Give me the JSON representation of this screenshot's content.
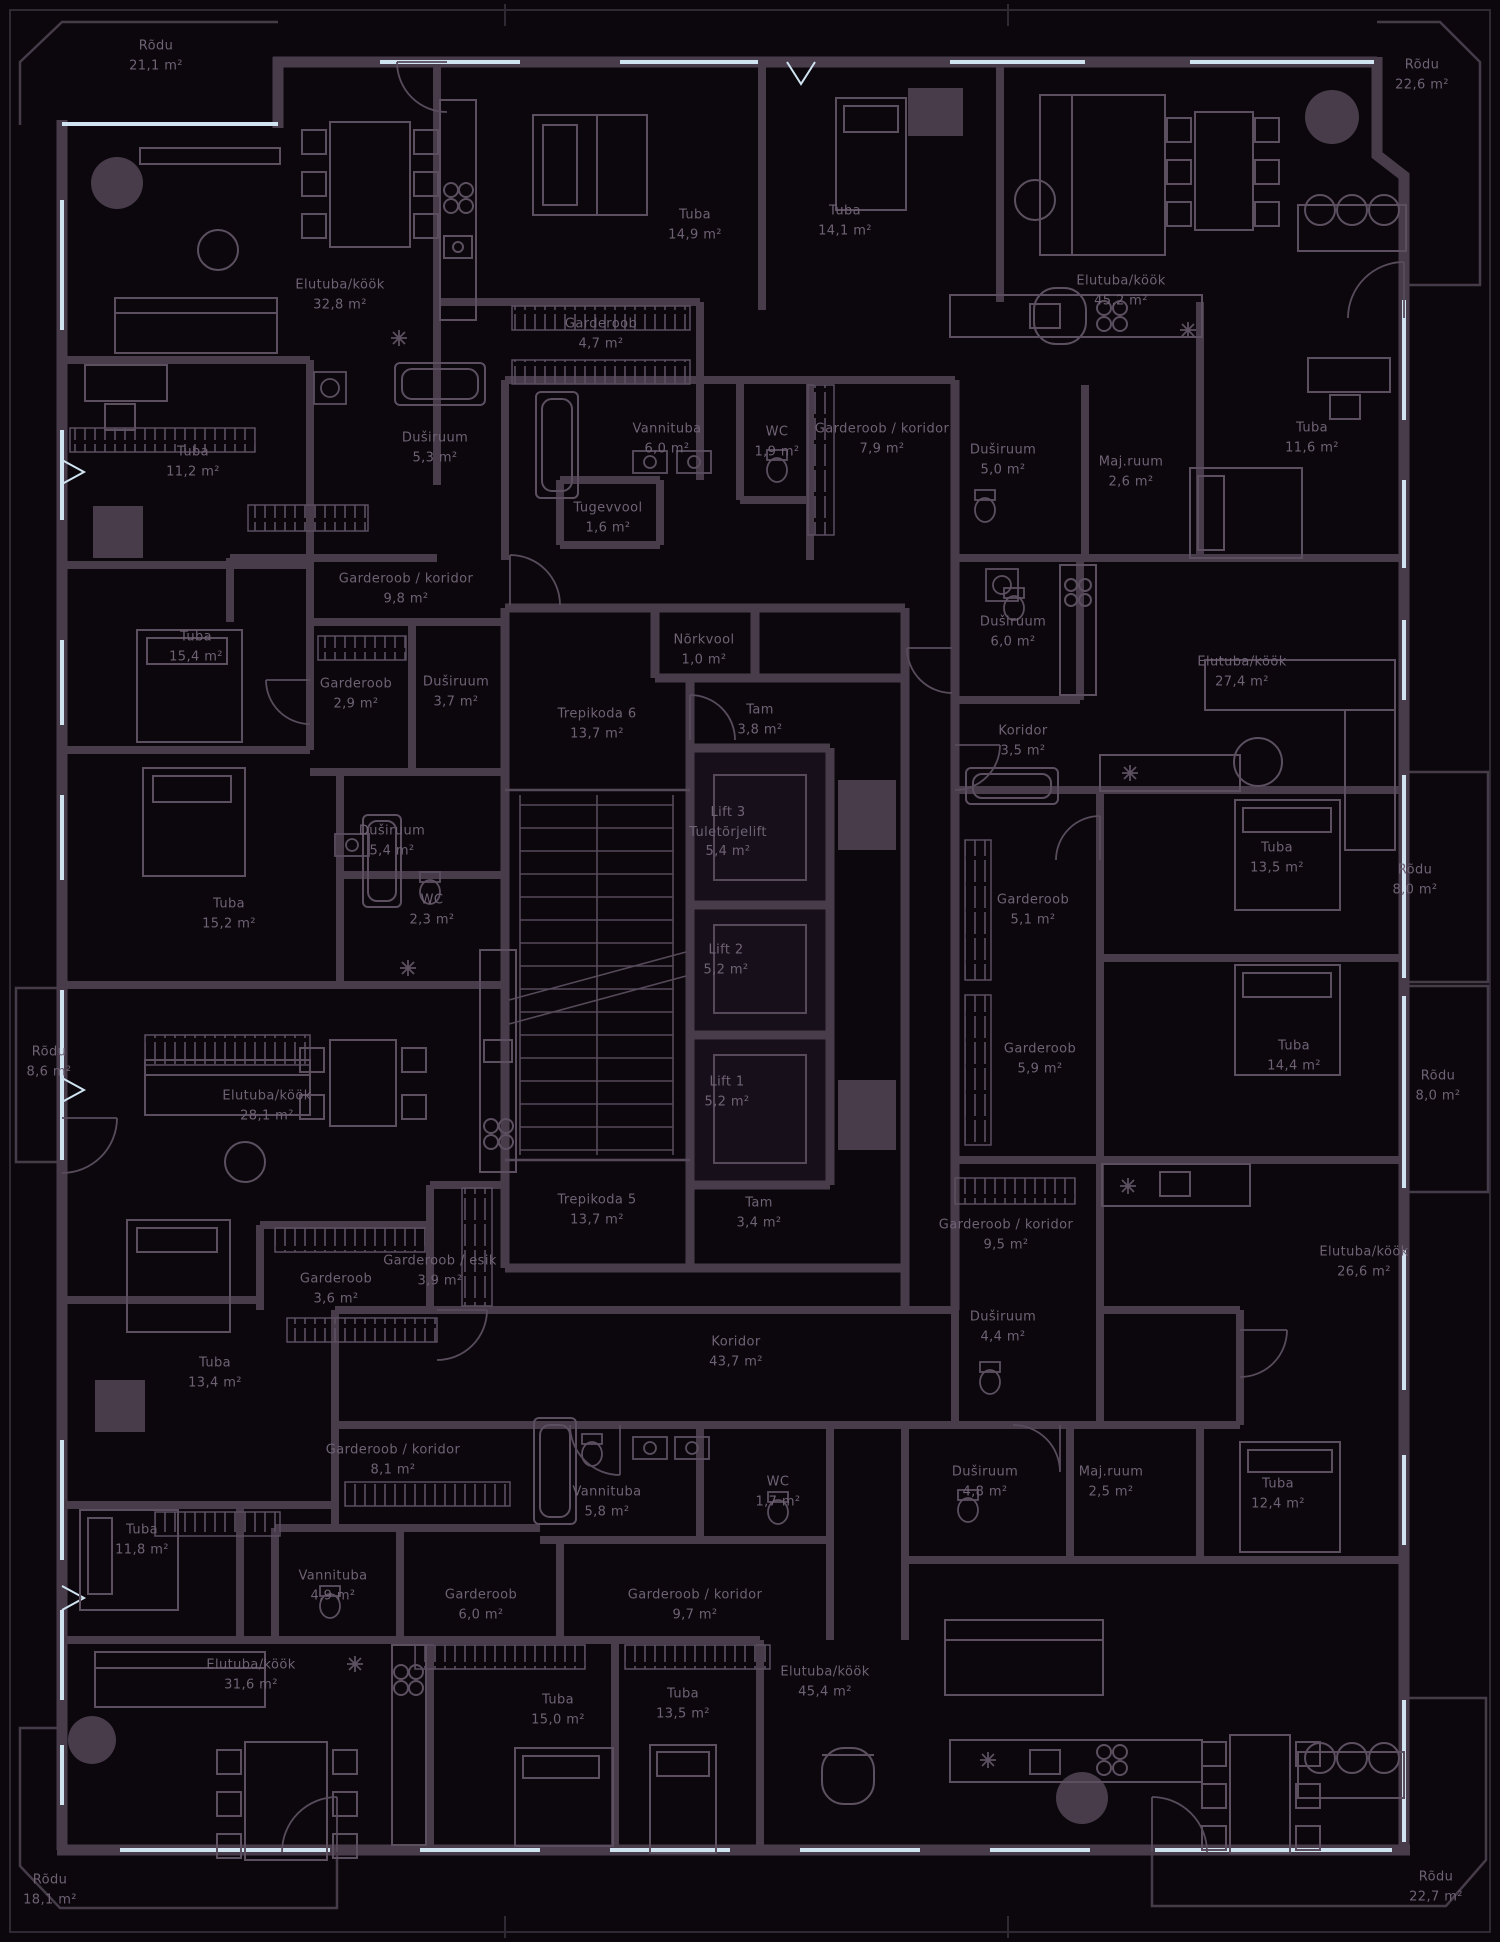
{
  "document": {
    "kind": "apartment floor plan",
    "language": "et"
  },
  "colors": {
    "background": "#0b070c",
    "wall": "#483c4b",
    "furniture": "#5b4f60",
    "glass_window": "#cfe3f1",
    "label_text": "#6f6275",
    "frame": "#2f2934"
  },
  "rooms": [
    {
      "name": "Rõdu",
      "area": "21,1 m²",
      "x": 156,
      "y": 56
    },
    {
      "name": "Rõdu",
      "area": "22,6 m²",
      "x": 1422,
      "y": 75
    },
    {
      "name": "Elutuba/köök",
      "area": "32,8 m²",
      "x": 340,
      "y": 295
    },
    {
      "name": "Tuba",
      "area": "14,9 m²",
      "x": 695,
      "y": 225
    },
    {
      "name": "Tuba",
      "area": "14,1 m²",
      "x": 845,
      "y": 221
    },
    {
      "name": "Elutuba/köök",
      "area": "45,2 m²",
      "x": 1121,
      "y": 291
    },
    {
      "name": "Garderoob",
      "area": "4,7 m²",
      "x": 601,
      "y": 334
    },
    {
      "name": "Duširuum",
      "area": "5,3 m²",
      "x": 435,
      "y": 448
    },
    {
      "name": "Vannituba",
      "area": "6,0 m²",
      "x": 667,
      "y": 439
    },
    {
      "name": "WC",
      "area": "1,9 m²",
      "x": 777,
      "y": 442
    },
    {
      "name": "Garderoob / koridor",
      "area": "7,9 m²",
      "x": 882,
      "y": 439
    },
    {
      "name": "Duširuum",
      "area": "5,0 m²",
      "x": 1003,
      "y": 460
    },
    {
      "name": "Maj.ruum",
      "area": "2,6 m²",
      "x": 1131,
      "y": 472
    },
    {
      "name": "Tuba",
      "area": "11,6 m²",
      "x": 1312,
      "y": 438
    },
    {
      "name": "Tuba",
      "area": "11,2 m²",
      "x": 193,
      "y": 462
    },
    {
      "name": "Tugevvool",
      "area": "1,6 m²",
      "x": 608,
      "y": 518
    },
    {
      "name": "Garderoob / koridor",
      "area": "9,8 m²",
      "x": 406,
      "y": 589
    },
    {
      "name": "Tuba",
      "area": "15,4 m²",
      "x": 196,
      "y": 647
    },
    {
      "name": "Garderoob",
      "area": "2,9 m²",
      "x": 356,
      "y": 694
    },
    {
      "name": "Duširuum",
      "area": "3,7 m²",
      "x": 456,
      "y": 692
    },
    {
      "name": "Nõrkvool",
      "area": "1,0 m²",
      "x": 704,
      "y": 650
    },
    {
      "name": "Duširuum",
      "area": "6,0 m²",
      "x": 1013,
      "y": 632
    },
    {
      "name": "Elutuba/köök",
      "area": "27,4 m²",
      "x": 1242,
      "y": 672
    },
    {
      "name": "Trepikoda 6",
      "area": "13,7 m²",
      "x": 597,
      "y": 724
    },
    {
      "name": "Tam",
      "area": "3,8 m²",
      "x": 760,
      "y": 720
    },
    {
      "name": "Koridor",
      "area": "3,5 m²",
      "x": 1023,
      "y": 741
    },
    {
      "name": "Lift 3",
      "name2": "Tuletõrjelift",
      "area": "5,4 m²",
      "x": 728,
      "y": 832
    },
    {
      "name": "Duširuum",
      "area": "5,4 m²",
      "x": 392,
      "y": 841
    },
    {
      "name": "Tuba",
      "area": "13,5 m²",
      "x": 1277,
      "y": 858
    },
    {
      "name": "Rõdu",
      "area": "8,0 m²",
      "x": 1415,
      "y": 880
    },
    {
      "name": "Tuba",
      "area": "15,2 m²",
      "x": 229,
      "y": 914
    },
    {
      "name": "WC",
      "area": "2,3 m²",
      "x": 432,
      "y": 910
    },
    {
      "name": "Garderoob",
      "area": "5,1 m²",
      "x": 1033,
      "y": 910
    },
    {
      "name": "Lift 2",
      "area": "5,2 m²",
      "x": 726,
      "y": 960
    },
    {
      "name": "Rõdu",
      "area": "8,6 m²",
      "x": 49,
      "y": 1062
    },
    {
      "name": "Garderoob",
      "area": "5,9 m²",
      "x": 1040,
      "y": 1059
    },
    {
      "name": "Tuba",
      "area": "14,4 m²",
      "x": 1294,
      "y": 1056
    },
    {
      "name": "Lift 1",
      "area": "5,2 m²",
      "x": 727,
      "y": 1092
    },
    {
      "name": "Rõdu",
      "area": "8,0 m²",
      "x": 1438,
      "y": 1086
    },
    {
      "name": "Elutuba/köök",
      "area": "28,1 m²",
      "x": 267,
      "y": 1106
    },
    {
      "name": "Trepikoda 5",
      "area": "13,7 m²",
      "x": 597,
      "y": 1210
    },
    {
      "name": "Tam",
      "area": "3,4 m²",
      "x": 759,
      "y": 1213
    },
    {
      "name": "Garderoob / koridor",
      "area": "9,5 m²",
      "x": 1006,
      "y": 1235
    },
    {
      "name": "Elutuba/köök",
      "area": "26,6 m²",
      "x": 1364,
      "y": 1262
    },
    {
      "name": "Garderoob / esik",
      "area": "3,9 m²",
      "x": 440,
      "y": 1271
    },
    {
      "name": "Garderoob",
      "area": "3,6 m²",
      "x": 336,
      "y": 1289
    },
    {
      "name": "Koridor",
      "area": "43,7 m²",
      "x": 736,
      "y": 1352
    },
    {
      "name": "Duširuum",
      "area": "4,4 m²",
      "x": 1003,
      "y": 1327
    },
    {
      "name": "Tuba",
      "area": "13,4 m²",
      "x": 215,
      "y": 1373
    },
    {
      "name": "Garderoob / koridor",
      "area": "8,1 m²",
      "x": 393,
      "y": 1460
    },
    {
      "name": "Vannituba",
      "area": "5,8 m²",
      "x": 607,
      "y": 1502
    },
    {
      "name": "WC",
      "area": "1,7 m²",
      "x": 778,
      "y": 1492
    },
    {
      "name": "Duširuum",
      "area": "4,8 m²",
      "x": 985,
      "y": 1482
    },
    {
      "name": "Maj.ruum",
      "area": "2,5 m²",
      "x": 1111,
      "y": 1482
    },
    {
      "name": "Tuba",
      "area": "12,4 m²",
      "x": 1278,
      "y": 1494
    },
    {
      "name": "Tuba",
      "area": "11,8 m²",
      "x": 142,
      "y": 1540
    },
    {
      "name": "Vannituba",
      "area": "4,9 m²",
      "x": 333,
      "y": 1586
    },
    {
      "name": "Garderoob",
      "area": "6,0 m²",
      "x": 481,
      "y": 1605
    },
    {
      "name": "Gardero­ob / koridor",
      "area": "9,7 m²",
      "x": 695,
      "y": 1605
    },
    {
      "name": "Elutuba/köök",
      "area": "31,6 m²",
      "x": 251,
      "y": 1675
    },
    {
      "name": "Tuba",
      "area": "15,0 m²",
      "x": 558,
      "y": 1710
    },
    {
      "name": "Tuba",
      "area": "13,5 m²",
      "x": 683,
      "y": 1704
    },
    {
      "name": "Elutuba/köök",
      "area": "45,4 m²",
      "x": 825,
      "y": 1682
    },
    {
      "name": "Rõdu",
      "area": "18,1 m²",
      "x": 50,
      "y": 1890
    },
    {
      "name": "Rõdu",
      "area": "22,7 m²",
      "x": 1436,
      "y": 1887
    }
  ]
}
